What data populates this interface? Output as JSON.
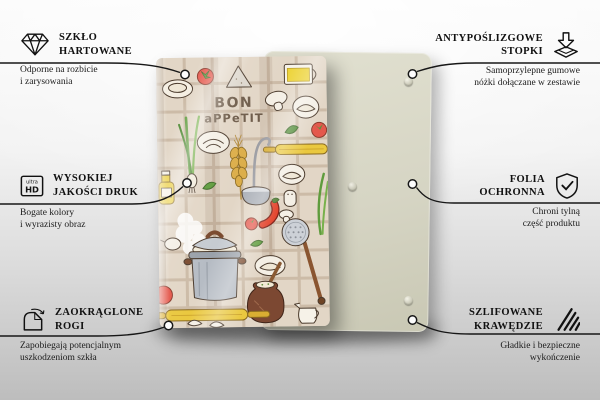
{
  "product": {
    "design_title_line1": "BON",
    "design_title_line2": "aPPeTIT"
  },
  "features": {
    "tempered_glass": {
      "title_line1": "SZKŁO",
      "title_line2": "HARTOWANE",
      "desc_line1": "Odporne na rozbicie",
      "desc_line2": "i zarysowania",
      "icon": "diamond-icon"
    },
    "print_quality": {
      "title_line1": "WYSOKIEJ",
      "title_line2": "JAKOŚCI DRUK",
      "desc_line1": "Bogate kolory",
      "desc_line2": "i wyrazisty obraz",
      "icon": "ultra-hd-icon",
      "icon_text_top": "ultra",
      "icon_text_bottom": "HD"
    },
    "rounded_corners": {
      "title_line1": "ZAOKRĄGLONE",
      "title_line2": "ROGI",
      "desc_line1": "Zapobiegają potencjalnym",
      "desc_line2": "uszkodzeniom szkła",
      "icon": "rounded-corner-icon"
    },
    "anti_slip_feet": {
      "title_line1": "ANTYPOŚLIZGOWE",
      "title_line2": "STOPKI",
      "desc_line1": "Samoprzylepne gumowe",
      "desc_line2": "nóżki dołączane w zestawie",
      "icon": "adhesive-feet-icon"
    },
    "protective_film": {
      "title_line1": "FOLIA",
      "title_line2": "OCHRONNA",
      "desc_line1": "Chroni tylną",
      "desc_line2": "część produktu",
      "icon": "shield-check-icon"
    },
    "polished_edges": {
      "title_line1": "SZLIFOWANE",
      "title_line2": "KRAWĘDZIE",
      "desc_line1": "Gładkie i bezpieczne",
      "desc_line2": "wykończenie",
      "icon": "polished-edges-icon"
    }
  },
  "colors": {
    "background_top": "#fbfbfb",
    "background_bottom": "#bdbdbd",
    "back_panel": "#d6d5c4",
    "design_background": "#e2d6c6",
    "design_text_brown": "#6d5b49",
    "label_text": "#111111",
    "connector_line": "#171717",
    "tomato_red": "#e4584c",
    "rolling_pin_yellow": "#eac83f",
    "pot_grey": "#b6bcc4",
    "clay_brown": "#7c4832"
  }
}
